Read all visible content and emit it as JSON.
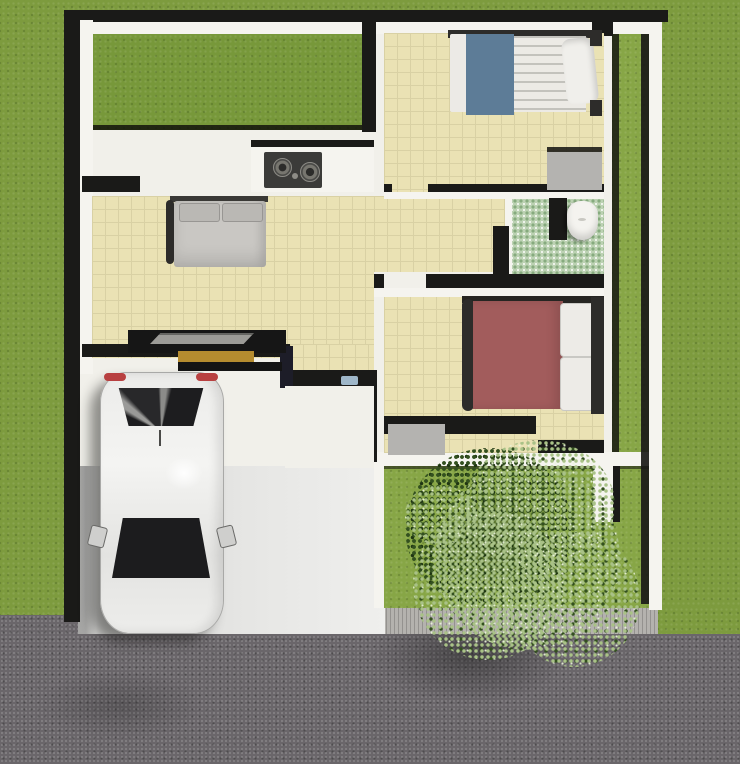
{
  "scene": {
    "type": "3d-floorplan-top-view",
    "labels": {
      "plot": "Small house plot surrounded by lawn",
      "courtyard": "Back garden courtyard",
      "bedroom_top": "Bedroom with single bed (blue blanket)",
      "master_bedroom": "Bedroom with gray double bed",
      "bedroom_bottom": "Bedroom with maroon double bed",
      "bathroom": "Bathroom with green mosaic floor",
      "kitchen": "Kitchen counter with cooktop",
      "hallway": "Hallway",
      "porch": "Entry porch",
      "doormat": "Front door mat",
      "driveway": "Concrete driveway",
      "car": "White car parked (top view)",
      "tree": "Garden tree canopy",
      "front_yard": "Front yard lawn",
      "side_yard": "Side yard lawn strip",
      "road": "Asphalt street",
      "sidewalk": "Sidewalk",
      "toilet": "Toilet",
      "stove": "Two-burner cooktop",
      "bench": "Entry bench",
      "console": "Console table with tray",
      "bed2_mat": "Gray rug",
      "bed3_mat": "Gray rug"
    }
  },
  "colors": {
    "grass_outer": "#7d9b3e",
    "grass_courtyard": "#77983a",
    "grass_yard": "#87a646",
    "wall_white": "#f5f4ef",
    "wall_shadow": "#1a1a18",
    "corridor_white": "#f1f0ea",
    "floor_beige": "#eae2b4",
    "floor_grid": "#d9d1a4",
    "bath_tile": "#bcd2b3",
    "bath_dot": "#86ab7e",
    "toilet_white": "#f4f3ef",
    "driveway_gray": "#dededc",
    "road_asphalt": "#6a666a",
    "sidewalk_gray": "#b4b2ae",
    "car_body": "#ececea",
    "car_glass": "#232325",
    "car_taillight": "#b84040",
    "bed_gray": "#c9c7c3",
    "pillow_gray": "#bab8b4",
    "bed_frame": "#2d2c2a",
    "bed_blue": "#5d7c97",
    "mattress_white": "#eceae5",
    "bed_maroon": "#a25c5c",
    "mat_gray": "#b4b3b0",
    "stove_dark": "#3b3b39",
    "bench_tan": "#b58c2f",
    "tray_gray": "#9c9b97",
    "console_black": "#161616",
    "bush_light": "#a9c287",
    "bush_dark": "#33501f",
    "doormat_blue": "#9fb7c9"
  }
}
